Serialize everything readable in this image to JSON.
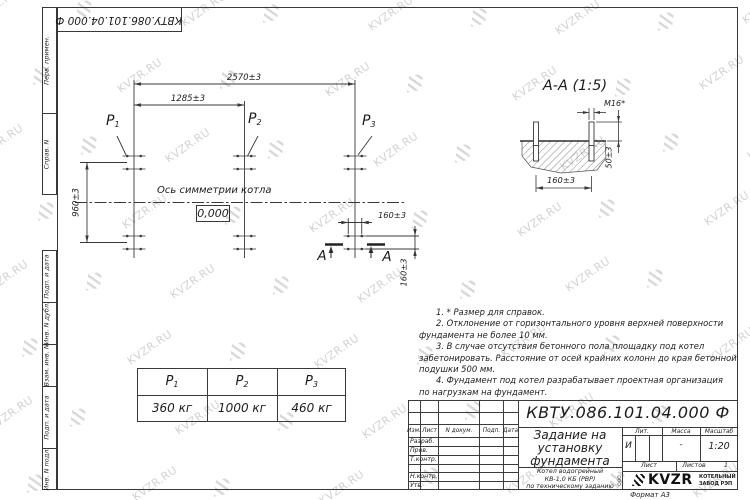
{
  "watermark": {
    "text": "KVZR.RU"
  },
  "stamp_top": {
    "doc_number_rotated": "КВТУ.086.101.04.000  Ф"
  },
  "side_columns": {
    "top": [
      "Перв. примен.",
      "Справ. N"
    ],
    "bottom": [
      "Подп. и дата",
      "Инв. N дубл.",
      "Взам. инв. N",
      "Подп. и дата",
      "Инв. N подл."
    ]
  },
  "plan": {
    "dim_total": "2570±3",
    "dim_half": "1285±3",
    "dim_depth": "960±3",
    "dim_bolt_h": "160±3",
    "dim_bolt_v": "160±3",
    "p_labels": [
      {
        "base": "P",
        "sub": "1"
      },
      {
        "base": "P",
        "sub": "2"
      },
      {
        "base": "P",
        "sub": "3"
      }
    ],
    "axis_label": "Ось симметрии котла",
    "level_mark": "0,000",
    "section_letter": "А"
  },
  "section_view": {
    "title": "А-А (1:5)",
    "bolt_label": "M16*",
    "dim_width": "160±3",
    "dim_height": "50±3"
  },
  "load_table": {
    "values": [
      "360 кг",
      "1000 кг",
      "460 кг"
    ]
  },
  "notes": {
    "lines": [
      "1.  * Размер для справок.",
      "2.  Отклонение от горизонтального уровня верхней поверхности",
      "фундамента не более 10 мм.",
      "3.  В случае отсутствия бетонного пола площадку под котел",
      "забетонировать. Расстояние от осей крайних колонн до края бетонной",
      "подушки 500 мм.",
      "4.  Фундамент под котел разрабатывает проектная организация",
      "по нагрузкам на фундамент."
    ]
  },
  "title_block": {
    "doc_number": "КВТУ.086.101.04.000  Ф",
    "title_lines": [
      "Задание на",
      "установку",
      "фундамента"
    ],
    "subtitle_lines": [
      "Котел водогрейный",
      "КВ-1,0 КБ (РВР)",
      "по техническому заданию"
    ],
    "header_cells": [
      "Изм.",
      "Лист",
      "N докум.",
      "Подп.",
      "Дата"
    ],
    "row_labels": [
      "Разраб.",
      "Пров.",
      "Т.контр.",
      "Н.контр.",
      "Утв."
    ],
    "lit_label": "Лит.",
    "lit_value": "И",
    "mass_label": "Масса",
    "mass_value": "-",
    "scale_label": "Масштаб",
    "scale_value": "1:20",
    "sheet_label": "Лист",
    "sheets_label": "Листов",
    "sheets_value": "1",
    "company": {
      "ooo": "ООО",
      "name": "KVZR",
      "tag_line1": "КОТЕЛЬНЫЙ",
      "tag_line2": "ЗАВОД РЭП"
    },
    "format_label": "Формат А3"
  }
}
